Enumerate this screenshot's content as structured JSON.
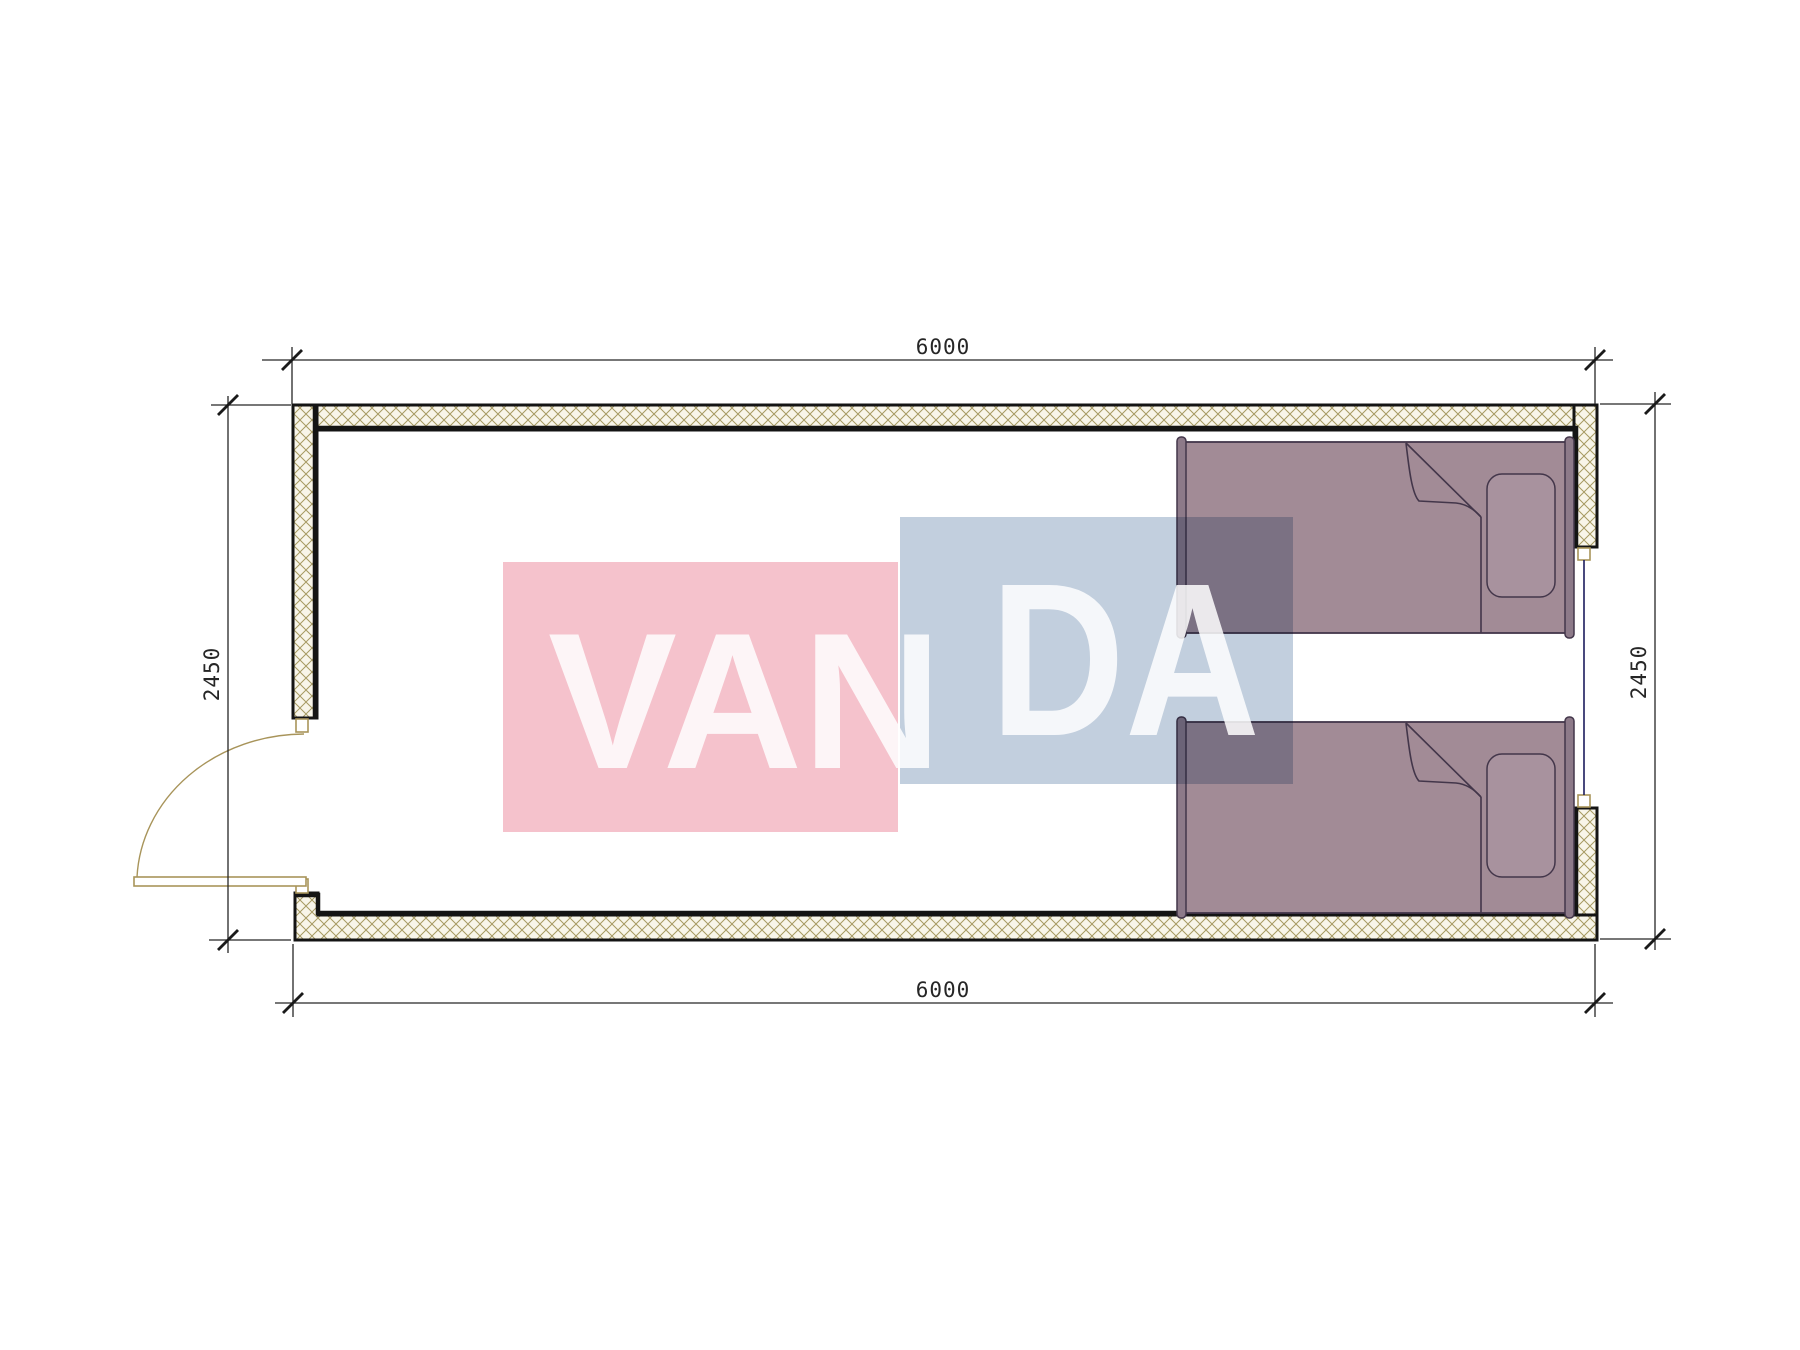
{
  "page": {
    "background": "#ffffff",
    "drawing_type": "floor-plan"
  },
  "dimensions": {
    "top_width": "6000",
    "bottom_width": "6000",
    "left_height": "2450",
    "right_height": "2450"
  },
  "watermark": {
    "text_left": "VAN",
    "text_right": "DA",
    "full_text": "VANDA",
    "pink_color": "#f5c2cc",
    "blue_color": "#c2cfde",
    "text_color": "#ffffff"
  },
  "colors": {
    "wall_fill": "#f8f5e9",
    "wall_hatch_line": "#a69a62",
    "wall_outline": "#141414",
    "dimension_line": "#262626",
    "bed_fill": "#a28b96",
    "bed_post_fill": "#8d7a89",
    "pillow_fill": "#a8929e",
    "bed_outline": "#43364a",
    "door_symbol": "#a8945a",
    "window_line": "#1c1c5e"
  }
}
